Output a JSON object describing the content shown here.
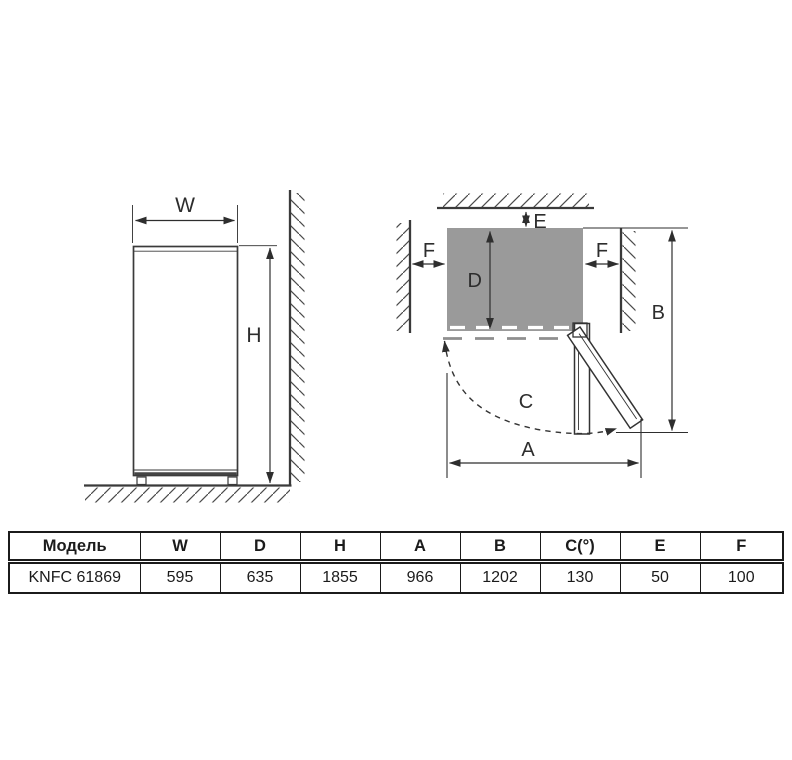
{
  "colors": {
    "line": "#333333",
    "fridge_top_fill": "#9a9a9a"
  },
  "front_view": {
    "labels": {
      "width": "W",
      "height": "H"
    }
  },
  "top_view": {
    "labels": {
      "depth": "D",
      "rear_clearance": "E",
      "side_clearance": "F",
      "open_depth": "B",
      "door_swing": "C",
      "open_width": "A"
    }
  },
  "table": {
    "headers": [
      "Модель",
      "W",
      "D",
      "H",
      "A",
      "B",
      "C(°)",
      "E",
      "F"
    ],
    "rows": [
      [
        "KNFC 61869",
        "595",
        "635",
        "1855",
        "966",
        "1202",
        "130",
        "50",
        "100"
      ]
    ]
  }
}
